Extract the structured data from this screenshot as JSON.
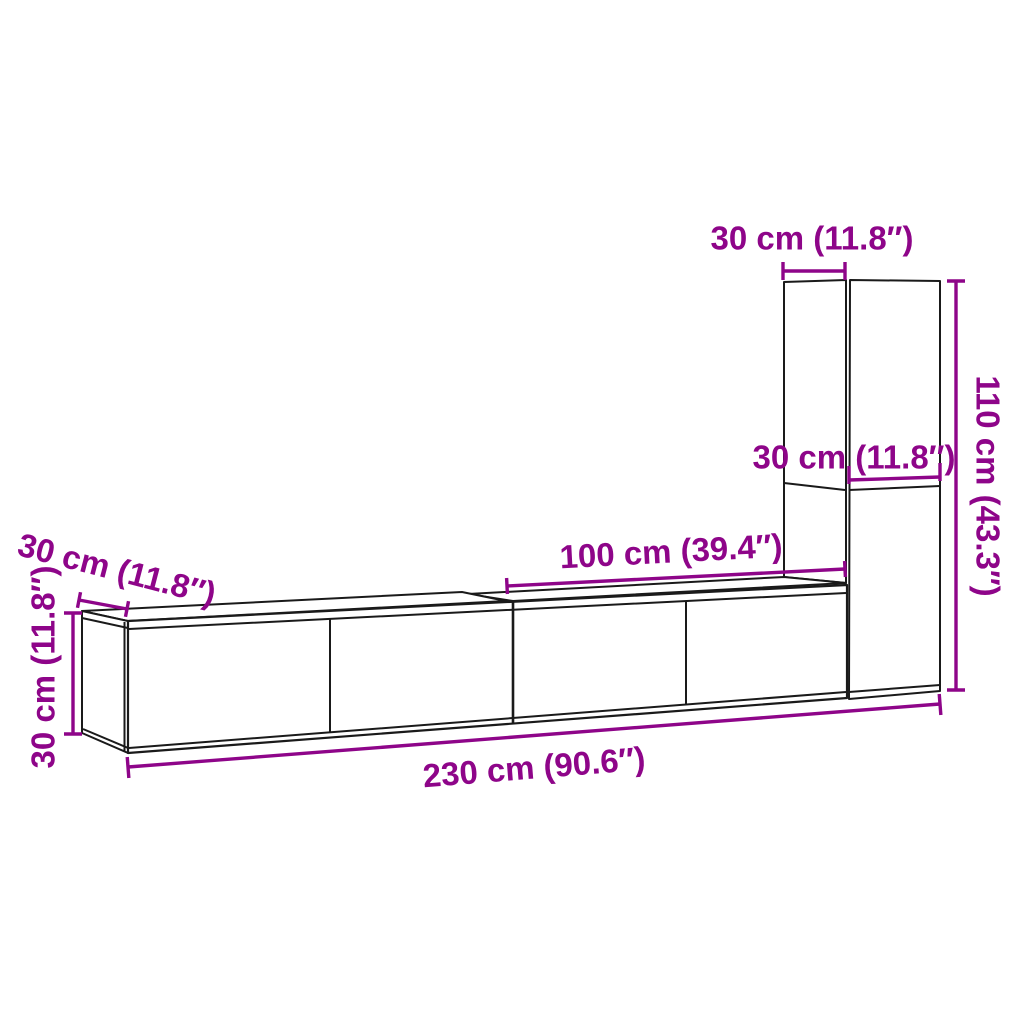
{
  "diagram": {
    "type": "furniture-dimension-diagram",
    "background": "#ffffff",
    "outline_color": "#1a1a1a",
    "dimension_color": "#8e0589",
    "annotations": {
      "tall_cabinet_width_top": "30 cm (11.8″)",
      "tall_cabinet_height": "110 cm (43.3″)",
      "tall_cabinet_width_middle": "30 cm (11.8″)",
      "tv_unit_width": "100 cm (39.4″)",
      "tv_unit_depth": "30 cm (11.8″)",
      "tv_unit_height": "30 cm (11.8″)",
      "total_width": "230 cm (90.6″)"
    }
  }
}
